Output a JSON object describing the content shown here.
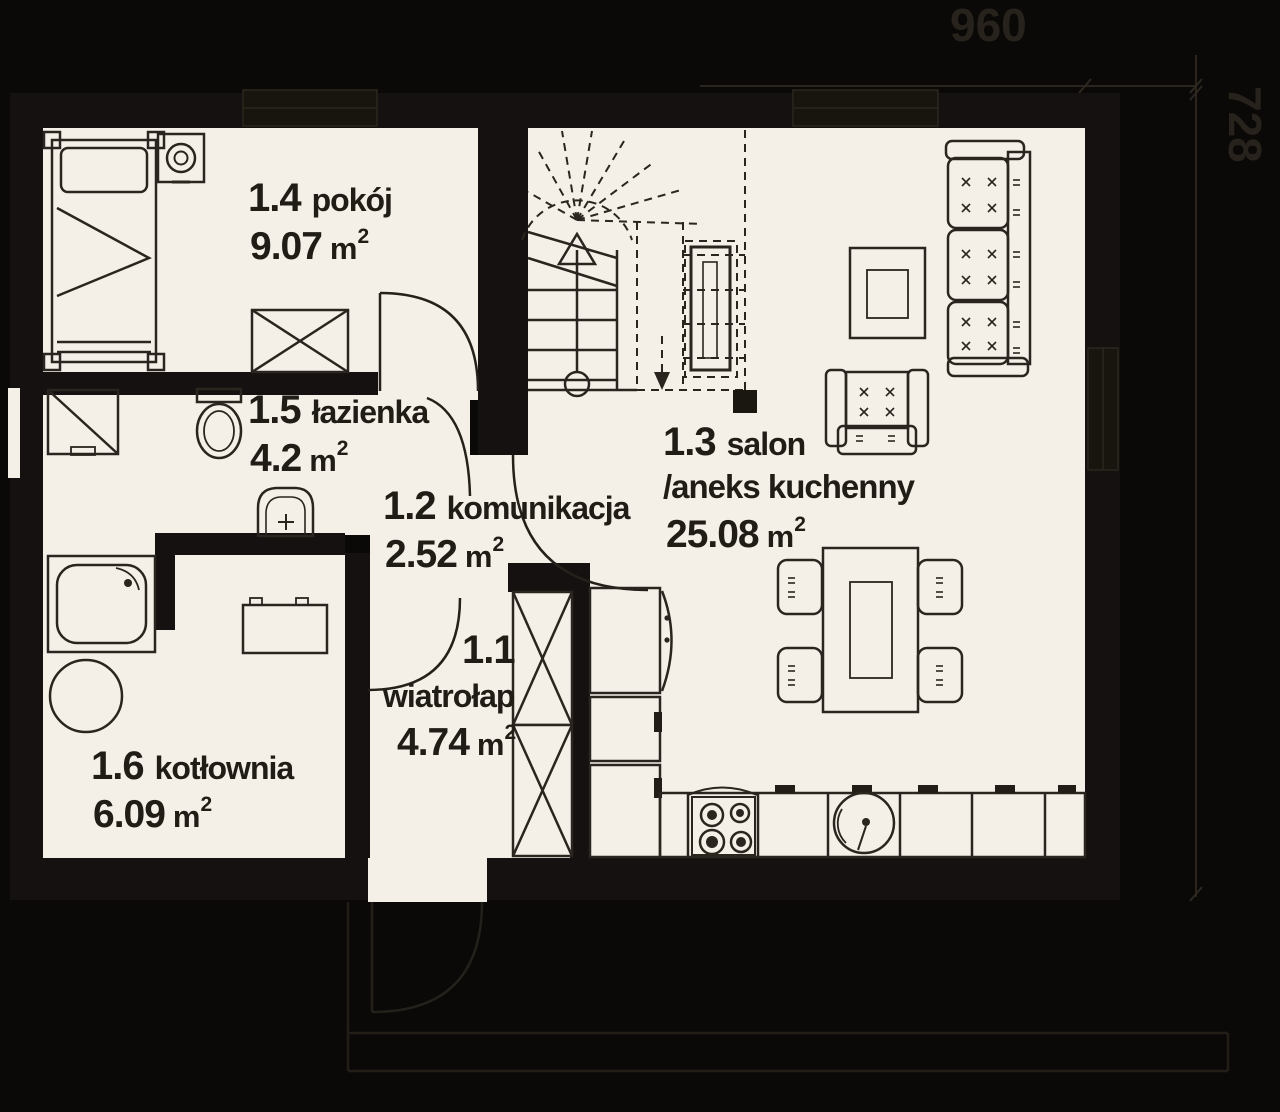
{
  "dimensions": {
    "width": "960",
    "height": "728"
  },
  "rooms": [
    {
      "number": "1.1",
      "name": "wiatrołap",
      "area": "4.74",
      "area_unit": "m",
      "area_sup": "2"
    },
    {
      "number": "1.2",
      "name": "komunikacja",
      "area": "2.52",
      "area_unit": "m",
      "area_sup": "2"
    },
    {
      "number": "1.3",
      "name": "salon",
      "name_line2": "/aneks kuchenny",
      "area": "25.08",
      "area_unit": "m",
      "area_sup": "2"
    },
    {
      "number": "1.4",
      "name": "pokój",
      "area": "9.07",
      "area_unit": "m",
      "area_sup": "2"
    },
    {
      "number": "1.5",
      "name": "łazienka",
      "area": "4.2",
      "area_unit": "m",
      "area_sup": "2"
    },
    {
      "number": "1.6",
      "name": "kotłownia",
      "area": "6.09",
      "area_unit": "m",
      "area_sup": "2"
    }
  ],
  "furniture_icons": [
    "bed",
    "nightstand-lamp",
    "wardrobe",
    "washing-machine",
    "toilet",
    "washbasin",
    "shower-tray",
    "boiler",
    "boiler-unit",
    "winder-staircase",
    "sofa",
    "coffee-table",
    "tv-cabinet",
    "armchair",
    "dining-table",
    "chair",
    "fridge",
    "kitchen-cabinet",
    "gas-stove",
    "kitchen-sink",
    "tall-cabinet",
    "interior-door",
    "entrance-door"
  ],
  "colors": {
    "background": "#0b0908",
    "floor": "#f4f0e8",
    "wall": "#151110",
    "line": "#2a251e",
    "dimension": "#2b261e"
  }
}
